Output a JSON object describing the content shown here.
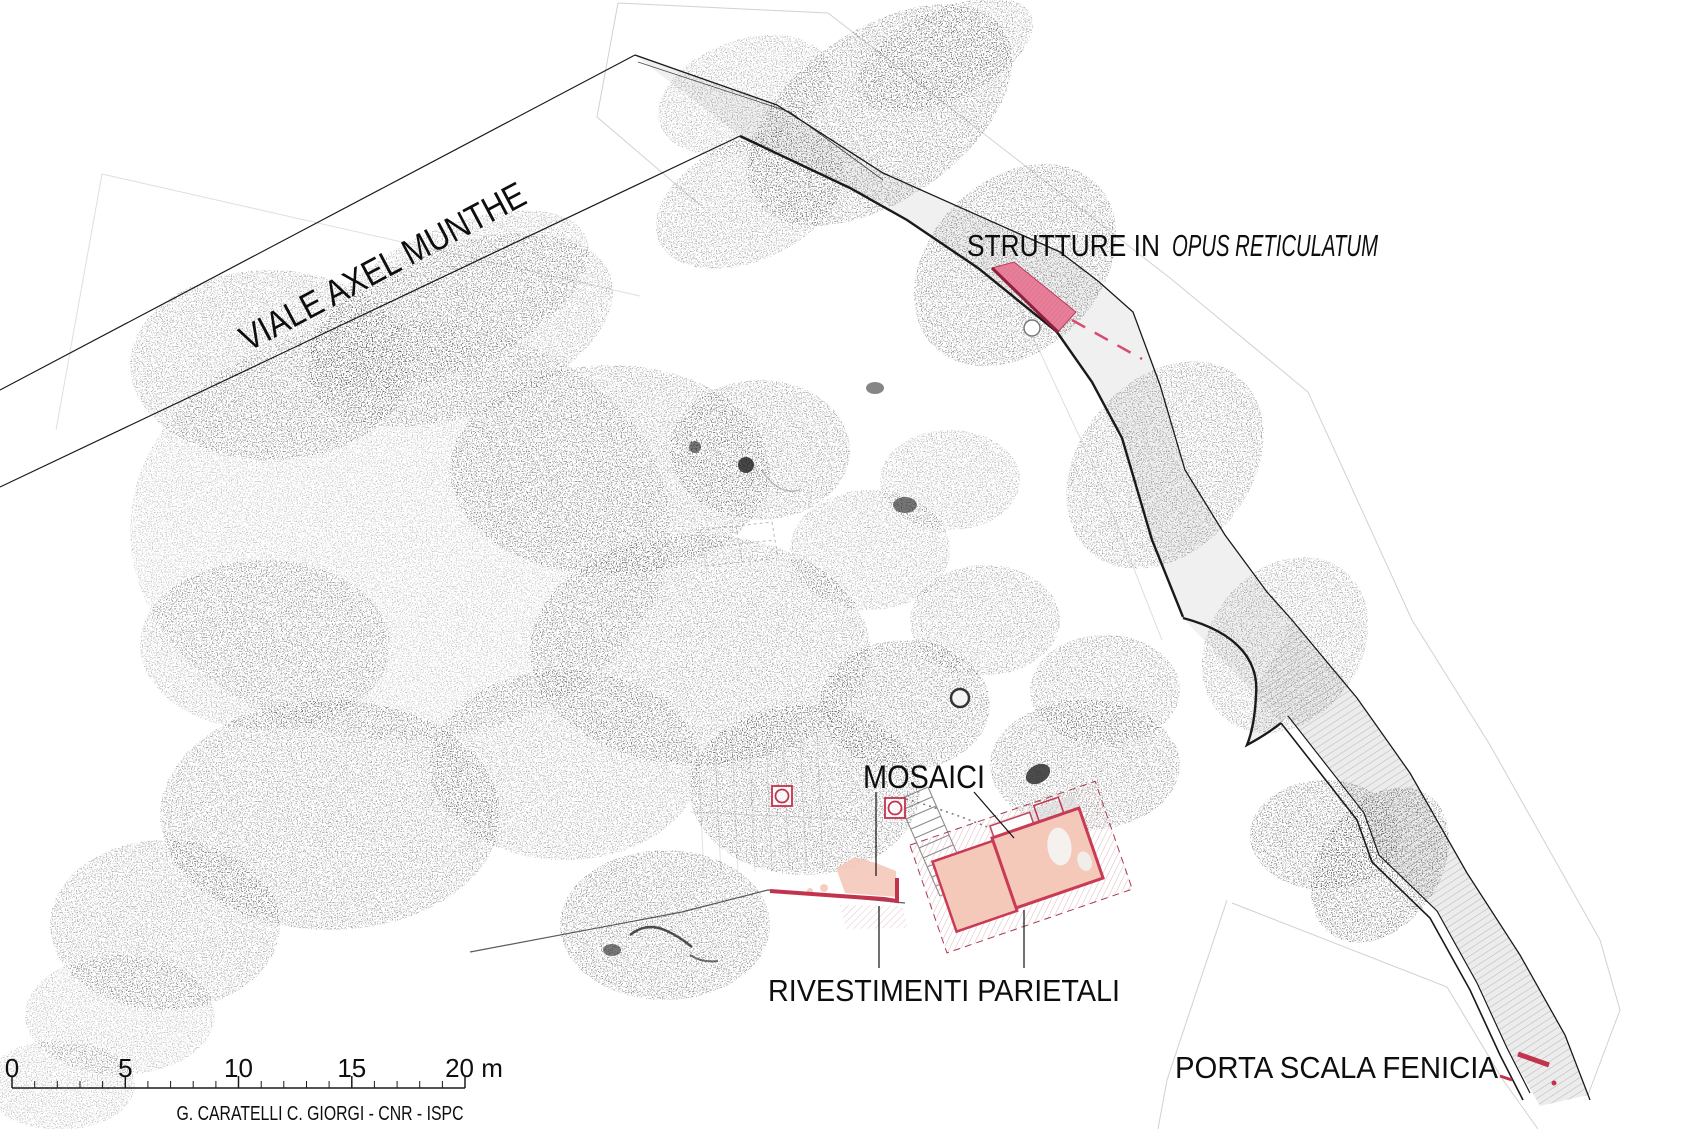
{
  "labels": {
    "viale": "VIALE AXEL MUNTHE",
    "strutture_prefix": "STRUTTURE IN ",
    "strutture_italic": "OPUS RETICULATUM",
    "mosaici": "MOSAICI",
    "rivestimenti": "RIVESTIMENTI PARIETALI",
    "porta": "PORTA SCALA FENICIA"
  },
  "scalebar": {
    "tick_labels": [
      "0",
      "5",
      "10",
      "15"
    ],
    "end_label": "20 m",
    "unit": "m",
    "total_meters": 20
  },
  "credit": "G. CARATELLI C. GIORGI - CNR - ISPC",
  "colors": {
    "highlight_pink_fill": "#e87f9a",
    "highlight_pink_edge": "#8f1f3d",
    "building_fill": "#f5c9ba",
    "building_border": "#c93a55",
    "red_wall": "#c2334e",
    "dashed_red": "#d84a6e",
    "plan_line": "#1a1a1a",
    "pointcloud_gray": "#444444",
    "scan_boundary": "#c9c9c9"
  }
}
